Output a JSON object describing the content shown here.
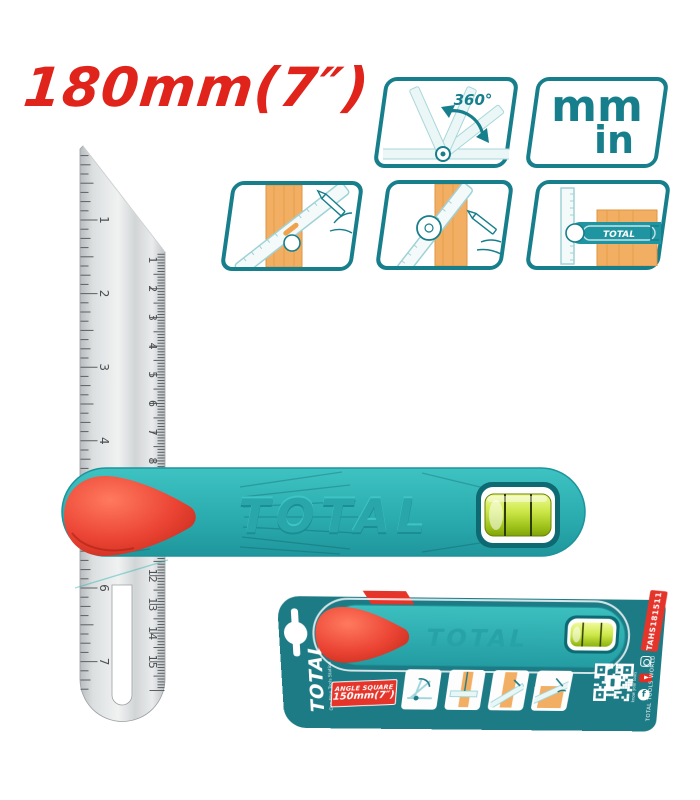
{
  "title": "180mm(7″)",
  "features": {
    "rotation_label": "360°",
    "unit_mm": "mm",
    "unit_in": "in",
    "usage_tool_label": "TOTAL"
  },
  "product": {
    "brand_emboss": "TOTAL",
    "scales": {
      "inch_numbers": [
        1,
        2,
        3,
        4,
        5,
        6,
        7
      ],
      "cm_numbers": [
        1,
        2,
        3,
        4,
        5,
        6,
        7,
        8,
        9,
        10,
        11,
        12,
        13,
        14,
        15
      ]
    }
  },
  "package": {
    "brand": "TOTAL",
    "tagline": "One-Stop Tools Station",
    "tool_emboss": "TOTAL",
    "badge_line1": "ANGLE SQUARE",
    "badge_line2": "150mm(7″)",
    "model": "TAHS181511",
    "qr_caption": "know your tools",
    "footer": "TOTAL TOOLS WORLD",
    "facebook_glyph": "f"
  },
  "colors": {
    "teal": "#2FB3B4",
    "teal_dark": "#177F8C",
    "card_teal": "#1D7B85",
    "red": "#E5352B",
    "title_red": "#E0241C",
    "vial_green": "#B5D625",
    "wood": "#F2AE63",
    "steel": "#D9DCDD"
  }
}
